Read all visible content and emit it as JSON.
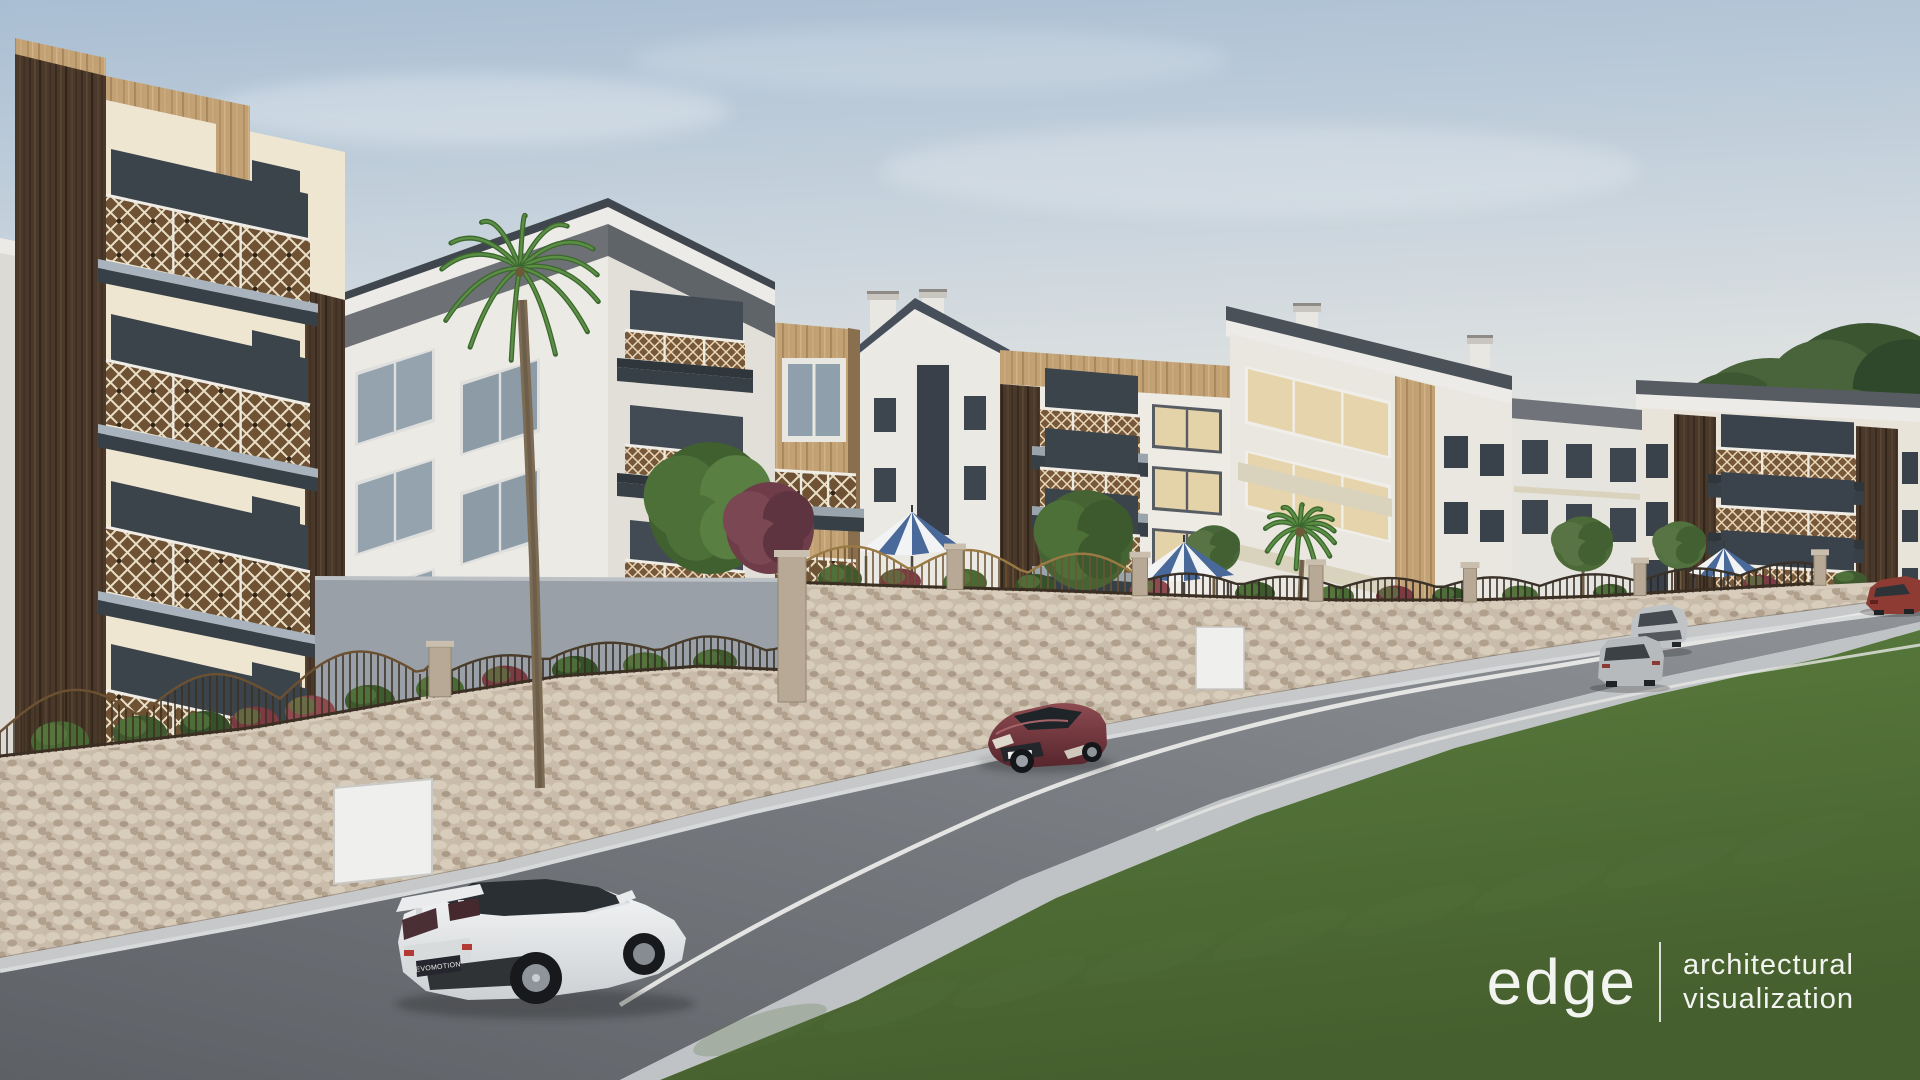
{
  "watermark": {
    "brand": "edge",
    "tagline_line1": "architectural",
    "tagline_line2": "visualization"
  },
  "vehicles": {
    "white_sports_sedan_plate": "EVOMOTION"
  },
  "palette": {
    "sky_top": "#a9bed3",
    "sky_horizon": "#f0ece3",
    "facade_cream": "#efe6d2",
    "facade_white": "#eae8e2",
    "band_grey": "#6c7074",
    "wood_dark": "#4a392b",
    "wood_tan": "#c2a175",
    "railing_bronze": "#6e5233",
    "fence_gold": "#9a7a44",
    "roof_slate": "#454c53",
    "stone_wall": "#c9bcab",
    "grey_wall": "#9aa0a7",
    "road_asphalt": "#6b6f74",
    "sidewalk": "#c0c3c6",
    "grass_green": "#567a3d",
    "gazebo_blue": "#49699b",
    "glass_cool": "#97a5b0",
    "glass_warm": "#e5d3aa",
    "car_white": "#eef0f1",
    "car_maroon": "#6e3238",
    "car_silver": "#b9bcc0",
    "car_red": "#8e3c33"
  }
}
